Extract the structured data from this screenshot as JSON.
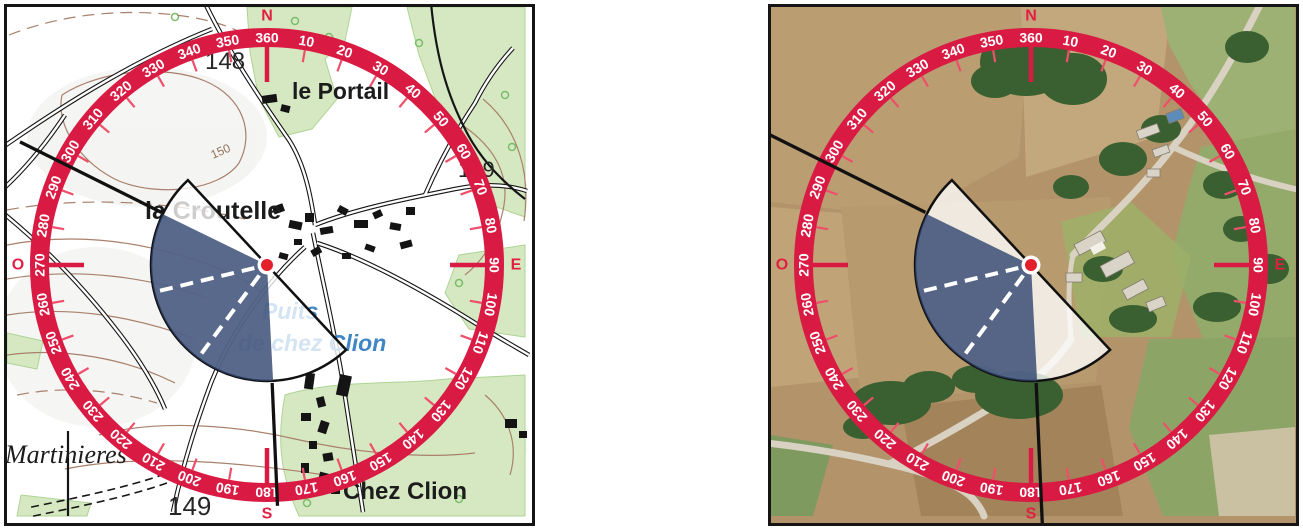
{
  "map_labels": {
    "le_portail": "le Portail",
    "la_croutelle": "la Croutelle",
    "chez_clion": "Chez Clion",
    "martinieres": "Martinieres",
    "puits_line1": "Puits",
    "puits_line2": "de chez Clion",
    "spot_height_148": "148",
    "spot_height_149_east": "149",
    "spot_height_149_south": "149",
    "contour_150": "150"
  },
  "compass": {
    "degree_labels": [
      "10",
      "20",
      "30",
      "40",
      "50",
      "60",
      "70",
      "80",
      "90",
      "100",
      "110",
      "120",
      "130",
      "140",
      "150",
      "160",
      "170",
      "180",
      "190",
      "200",
      "210",
      "220",
      "230",
      "240",
      "250",
      "260",
      "270",
      "280",
      "290",
      "300",
      "310",
      "320",
      "330",
      "340",
      "350",
      "360"
    ],
    "degree_step": 10,
    "cardinals": [
      {
        "label": "N",
        "deg": 360
      },
      {
        "label": "E",
        "deg": 90
      },
      {
        "label": "S",
        "deg": 180
      },
      {
        "label": "O",
        "deg": 270
      }
    ],
    "colors": {
      "ring": "#d91b44",
      "tick_minor": "#ee4f6b",
      "tick_cardinal": "#d91b44",
      "label_text": "#ffffff",
      "cardinal_text": "#e11f43"
    }
  },
  "fan": {
    "sector_start_deg": 137,
    "sector_end_deg": 317,
    "blue_start_deg": 177,
    "blue_end_deg": 296,
    "dashed_bearings_deg": [
      216.5,
      256.5
    ],
    "colors": {
      "blue": "rgba(47,68,110,0.80)",
      "white": "rgba(255,255,255,0.78)",
      "outline": "#111111",
      "dashed": "#ffffff",
      "center_dot": "#e41f2c"
    },
    "bearing_lines": {
      "left": [
        {
          "deg": 296.5,
          "r1": 118,
          "r2": 276
        },
        {
          "deg": 177.5,
          "r1": 118,
          "r2": 241
        }
      ],
      "right": [
        {
          "deg": 296.5,
          "r1": 118,
          "r2": 305
        },
        {
          "deg": 177.5,
          "r1": 118,
          "r2": 266
        }
      ]
    }
  }
}
